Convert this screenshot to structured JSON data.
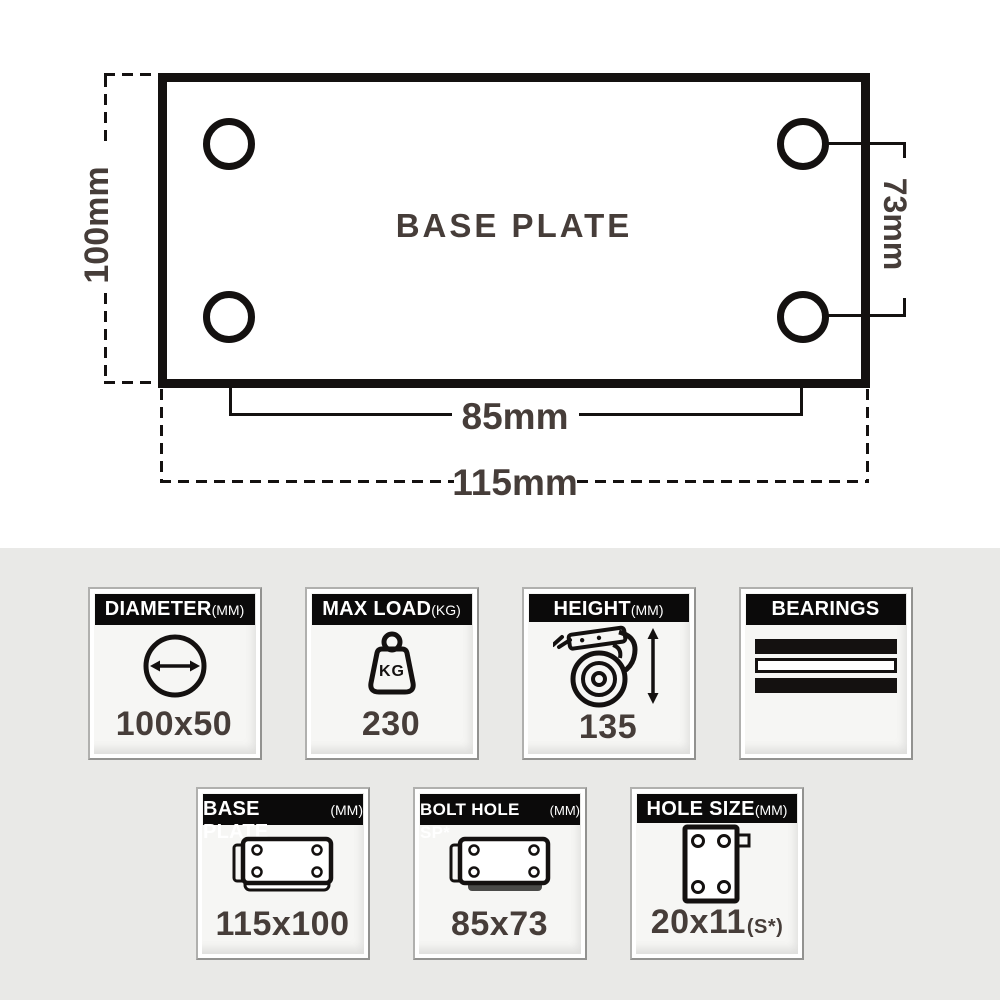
{
  "colors": {
    "ink": "#141110",
    "dim_text": "#463d39",
    "top_bg": "#ffffff",
    "bottom_bg": "#e9e9e7",
    "card_bg": "#f6f6f4",
    "card_header_bg": "#0b0a0a",
    "card_header_text": "#ffffff",
    "bolt_bar_gray": "#4a4a48"
  },
  "diagram": {
    "title": "BASE PLATE",
    "dims": {
      "plate_height": "100mm",
      "bolt_spacing_vertical": "73mm",
      "bolt_spacing_horizontal": "85mm",
      "plate_width": "115mm"
    }
  },
  "icons": {
    "kg_badge": "KG"
  },
  "spec_cards": {
    "row1": [
      {
        "label": "DIAMETER",
        "unit": "(MM)",
        "icon": "diameter-icon",
        "value": "100x50",
        "value_suffix": ""
      },
      {
        "label": "MAX LOAD",
        "unit": "(KG)",
        "icon": "max-load-kettlebell-icon",
        "value": "230",
        "value_suffix": ""
      },
      {
        "label": "HEIGHT",
        "unit": "(MM)",
        "icon": "caster-height-icon",
        "value": "135",
        "value_suffix": ""
      },
      {
        "label": "BEARINGS",
        "unit": "",
        "icon": "bearings-icon",
        "value": "",
        "value_suffix": ""
      }
    ],
    "row2": [
      {
        "label": "BASE PLATE",
        "unit": "(MM)",
        "icon": "base-plate-icon",
        "value": "115x100",
        "value_suffix": ""
      },
      {
        "label": "BOLT HOLE SP*",
        "unit": "(MM)",
        "icon": "bolt-hole-spacing-icon",
        "value": "85x73",
        "value_suffix": ""
      },
      {
        "label": "HOLE SIZE",
        "unit": "(MM)",
        "icon": "hole-size-icon",
        "value": "20x11",
        "value_suffix": "(S*)"
      }
    ]
  }
}
